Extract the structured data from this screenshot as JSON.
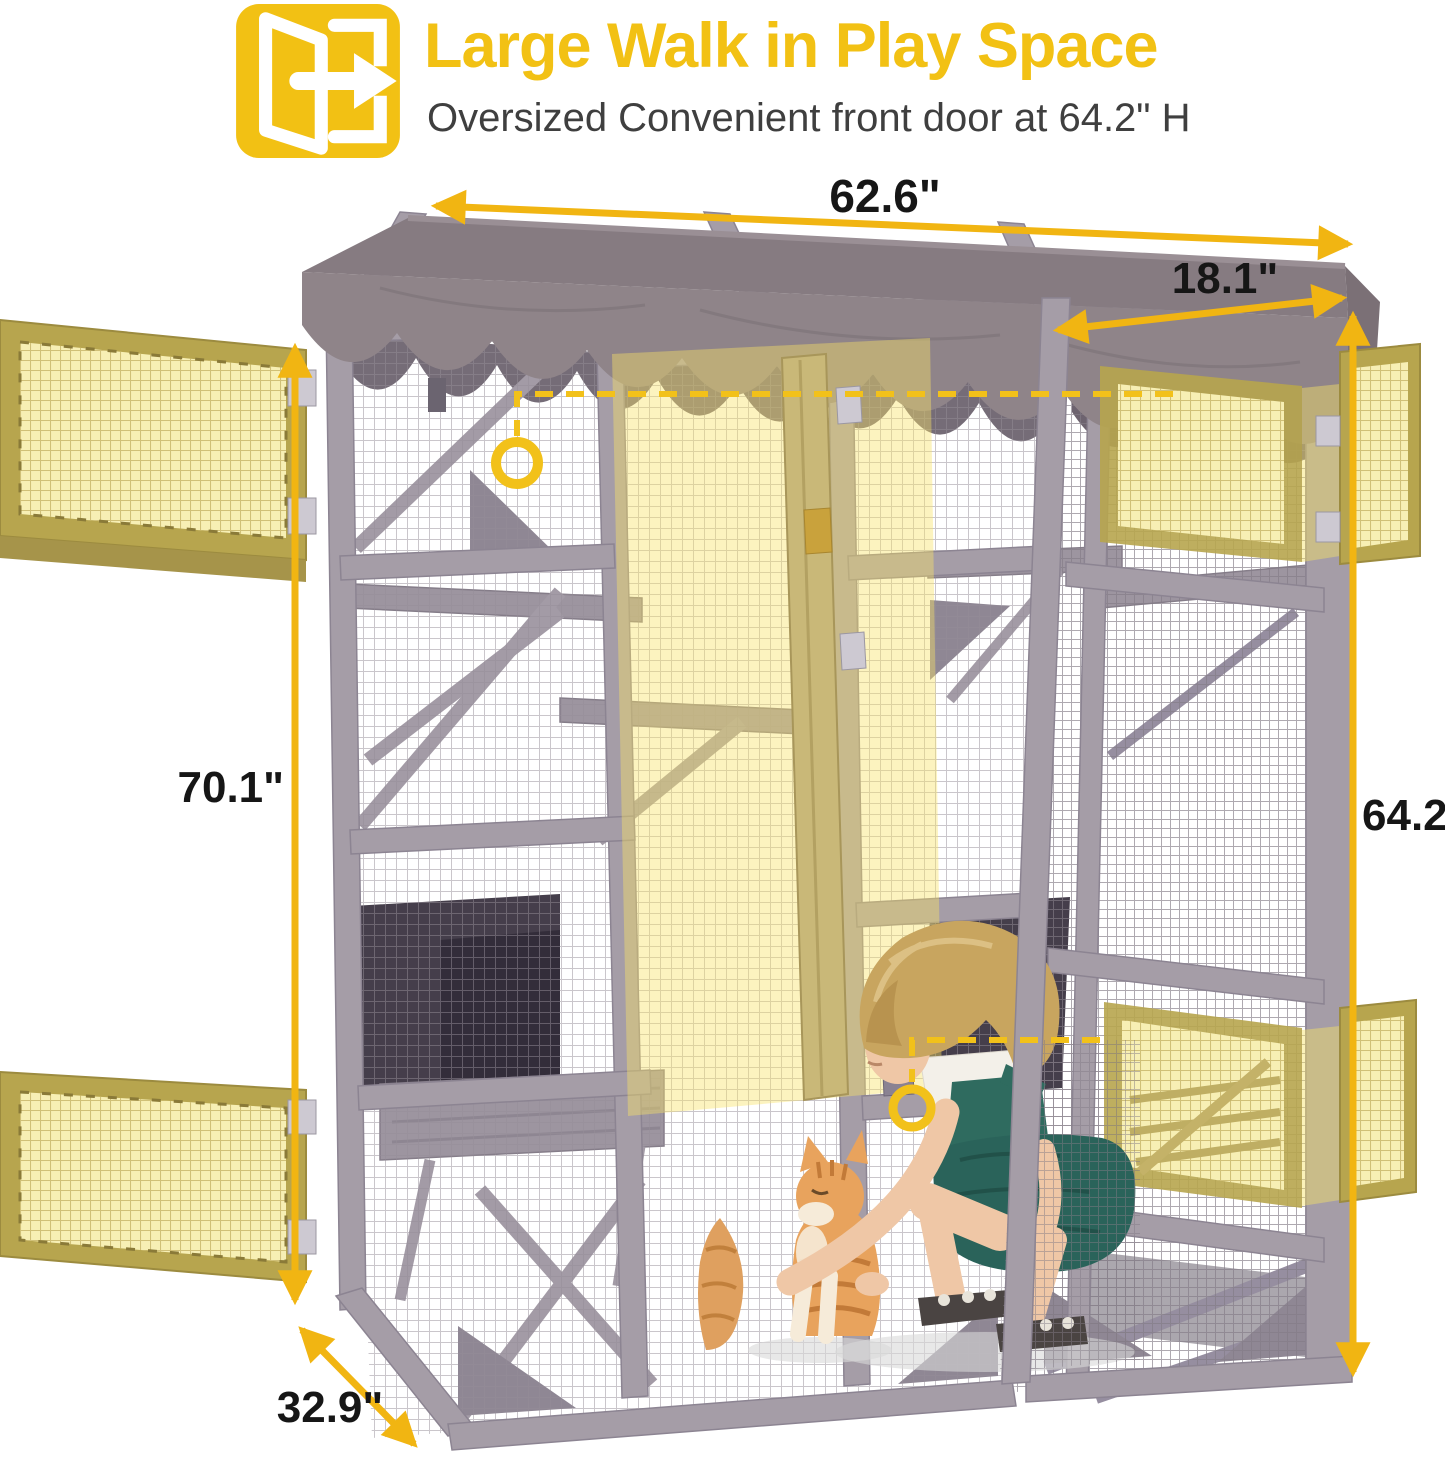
{
  "header": {
    "icon": "walk-in-door-icon",
    "title": "Large Walk in Play Space",
    "subtitle": "Oversized Convenient front door at 64.2\" H"
  },
  "dimensions": {
    "top_width": "62.6\"",
    "top_depth": "18.1\"",
    "left_height": "70.1\"",
    "right_door_height": "64.2\"",
    "bottom_depth": "32.9\""
  },
  "colors": {
    "accent_yellow": "#F2C114",
    "dimension_arrow_yellow": "#F1B512",
    "dimension_label_black": "#161616",
    "subtitle_gray": "#3F3F3F",
    "highlight_door_fill": "#F7EFB4",
    "highlight_door_frame_gold": "#B7A54E",
    "frame_wood_gray": "#A59DA7",
    "roof_canopy_taupe": "#8F8489"
  }
}
